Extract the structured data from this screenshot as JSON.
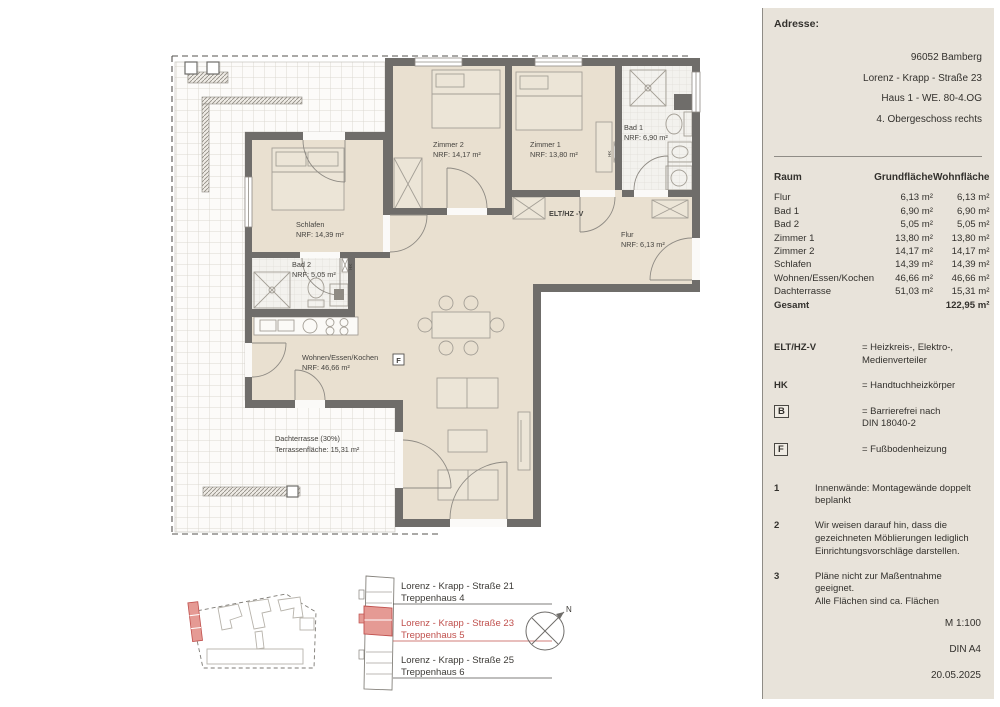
{
  "panel": {
    "adresse_label": "Adresse:",
    "address_lines": [
      "96052 Bamberg",
      "Lorenz - Krapp - Straße 23",
      "Haus 1 - WE. 80-4.OG",
      "4. Obergeschoss rechts"
    ],
    "table": {
      "col_raum": "Raum",
      "col_grund": "Grundfläche",
      "col_wohn": "Wohnfläche",
      "rows": [
        {
          "raum": "Flur",
          "grund": "6,13 m²",
          "wohn": "6,13 m²"
        },
        {
          "raum": "Bad 1",
          "grund": "6,90 m²",
          "wohn": "6,90 m²"
        },
        {
          "raum": "Bad 2",
          "grund": "5,05 m²",
          "wohn": "5,05 m²"
        },
        {
          "raum": "Zimmer 1",
          "grund": "13,80 m²",
          "wohn": "13,80 m²"
        },
        {
          "raum": "Zimmer 2",
          "grund": "14,17 m²",
          "wohn": "14,17 m²"
        },
        {
          "raum": "Schlafen",
          "grund": "14,39 m²",
          "wohn": "14,39 m²"
        },
        {
          "raum": "Wohnen/Essen/Kochen",
          "grund": "46,66 m²",
          "wohn": "46,66 m²"
        },
        {
          "raum": "Dachterrasse",
          "grund": "51,03 m²",
          "wohn": "15,31 m²"
        }
      ],
      "total": {
        "raum": "Gesamt",
        "grund": "",
        "wohn": "122,95 m²"
      }
    },
    "legend": {
      "elt": {
        "key": "ELT/HZ-V",
        "line1": "= Heizkreis-, Elektro-,",
        "line2": "Medienverteiler"
      },
      "hk": {
        "key": "HK",
        "line1": "= Handtuchheizkörper"
      },
      "b": {
        "key": "B",
        "line1": "= Barrierefrei nach",
        "line2": "DIN 18040-2"
      },
      "f": {
        "key": "F",
        "line1": "= Fußbodenheizung"
      }
    },
    "notes": [
      {
        "num": "1",
        "line1": "Innenwände: Montagewände doppelt",
        "line2": "beplankt"
      },
      {
        "num": "2",
        "line1": "Wir weisen darauf hin, dass die",
        "line2": "gezeichneten Möblierungen lediglich",
        "line3": "Einrichtungsvorschläge darstellen."
      },
      {
        "num": "3",
        "line1": "Pläne nicht zur Maßentnahme geeignet.",
        "line2": "Alle Flächen sind ca. Flächen"
      }
    ],
    "scale": "M 1:100",
    "format": "DIN A4",
    "date": "20.05.2025"
  },
  "plan": {
    "rooms": [
      {
        "name": "Zimmer 2",
        "area": "NRF: 14,17 m²"
      },
      {
        "name": "Zimmer 1",
        "area": "NRF: 13,80 m²"
      },
      {
        "name": "Bad 1",
        "area": "NRF: 6,90 m²"
      },
      {
        "name": "Schlafen",
        "area": "NRF: 14,39 m²"
      },
      {
        "name": "Bad 2",
        "area": "NRF: 5,05 m²"
      },
      {
        "name": "Flur",
        "area": "NRF: 6,13 m²"
      },
      {
        "name": "Wohnen/Essen/Kochen",
        "area": "NRF: 46,66 m²"
      },
      {
        "name": "Dachterrasse (30%)",
        "area": "Terrassenfläche: 15,31 m²"
      }
    ],
    "elt_label": "ELT/HZ -V",
    "f_symbol": "F",
    "hk_symbol": "HK"
  },
  "locator": {
    "entries": [
      {
        "street": "Lorenz - Krapp - Straße 21",
        "stair": "Treppenhaus 4"
      },
      {
        "street": "Lorenz - Krapp - Straße 23",
        "stair": "Treppenhaus 5"
      },
      {
        "street": "Lorenz - Krapp - Straße 25",
        "stair": "Treppenhaus 6"
      }
    ],
    "compass": "N"
  },
  "colors": {
    "highlight_red": "#c0504d",
    "highlight_fill": "#e59a94",
    "wall_gray": "#6f6d6a",
    "room_beige": "#e9e0d0",
    "panel_bg": "#e8e3da"
  }
}
